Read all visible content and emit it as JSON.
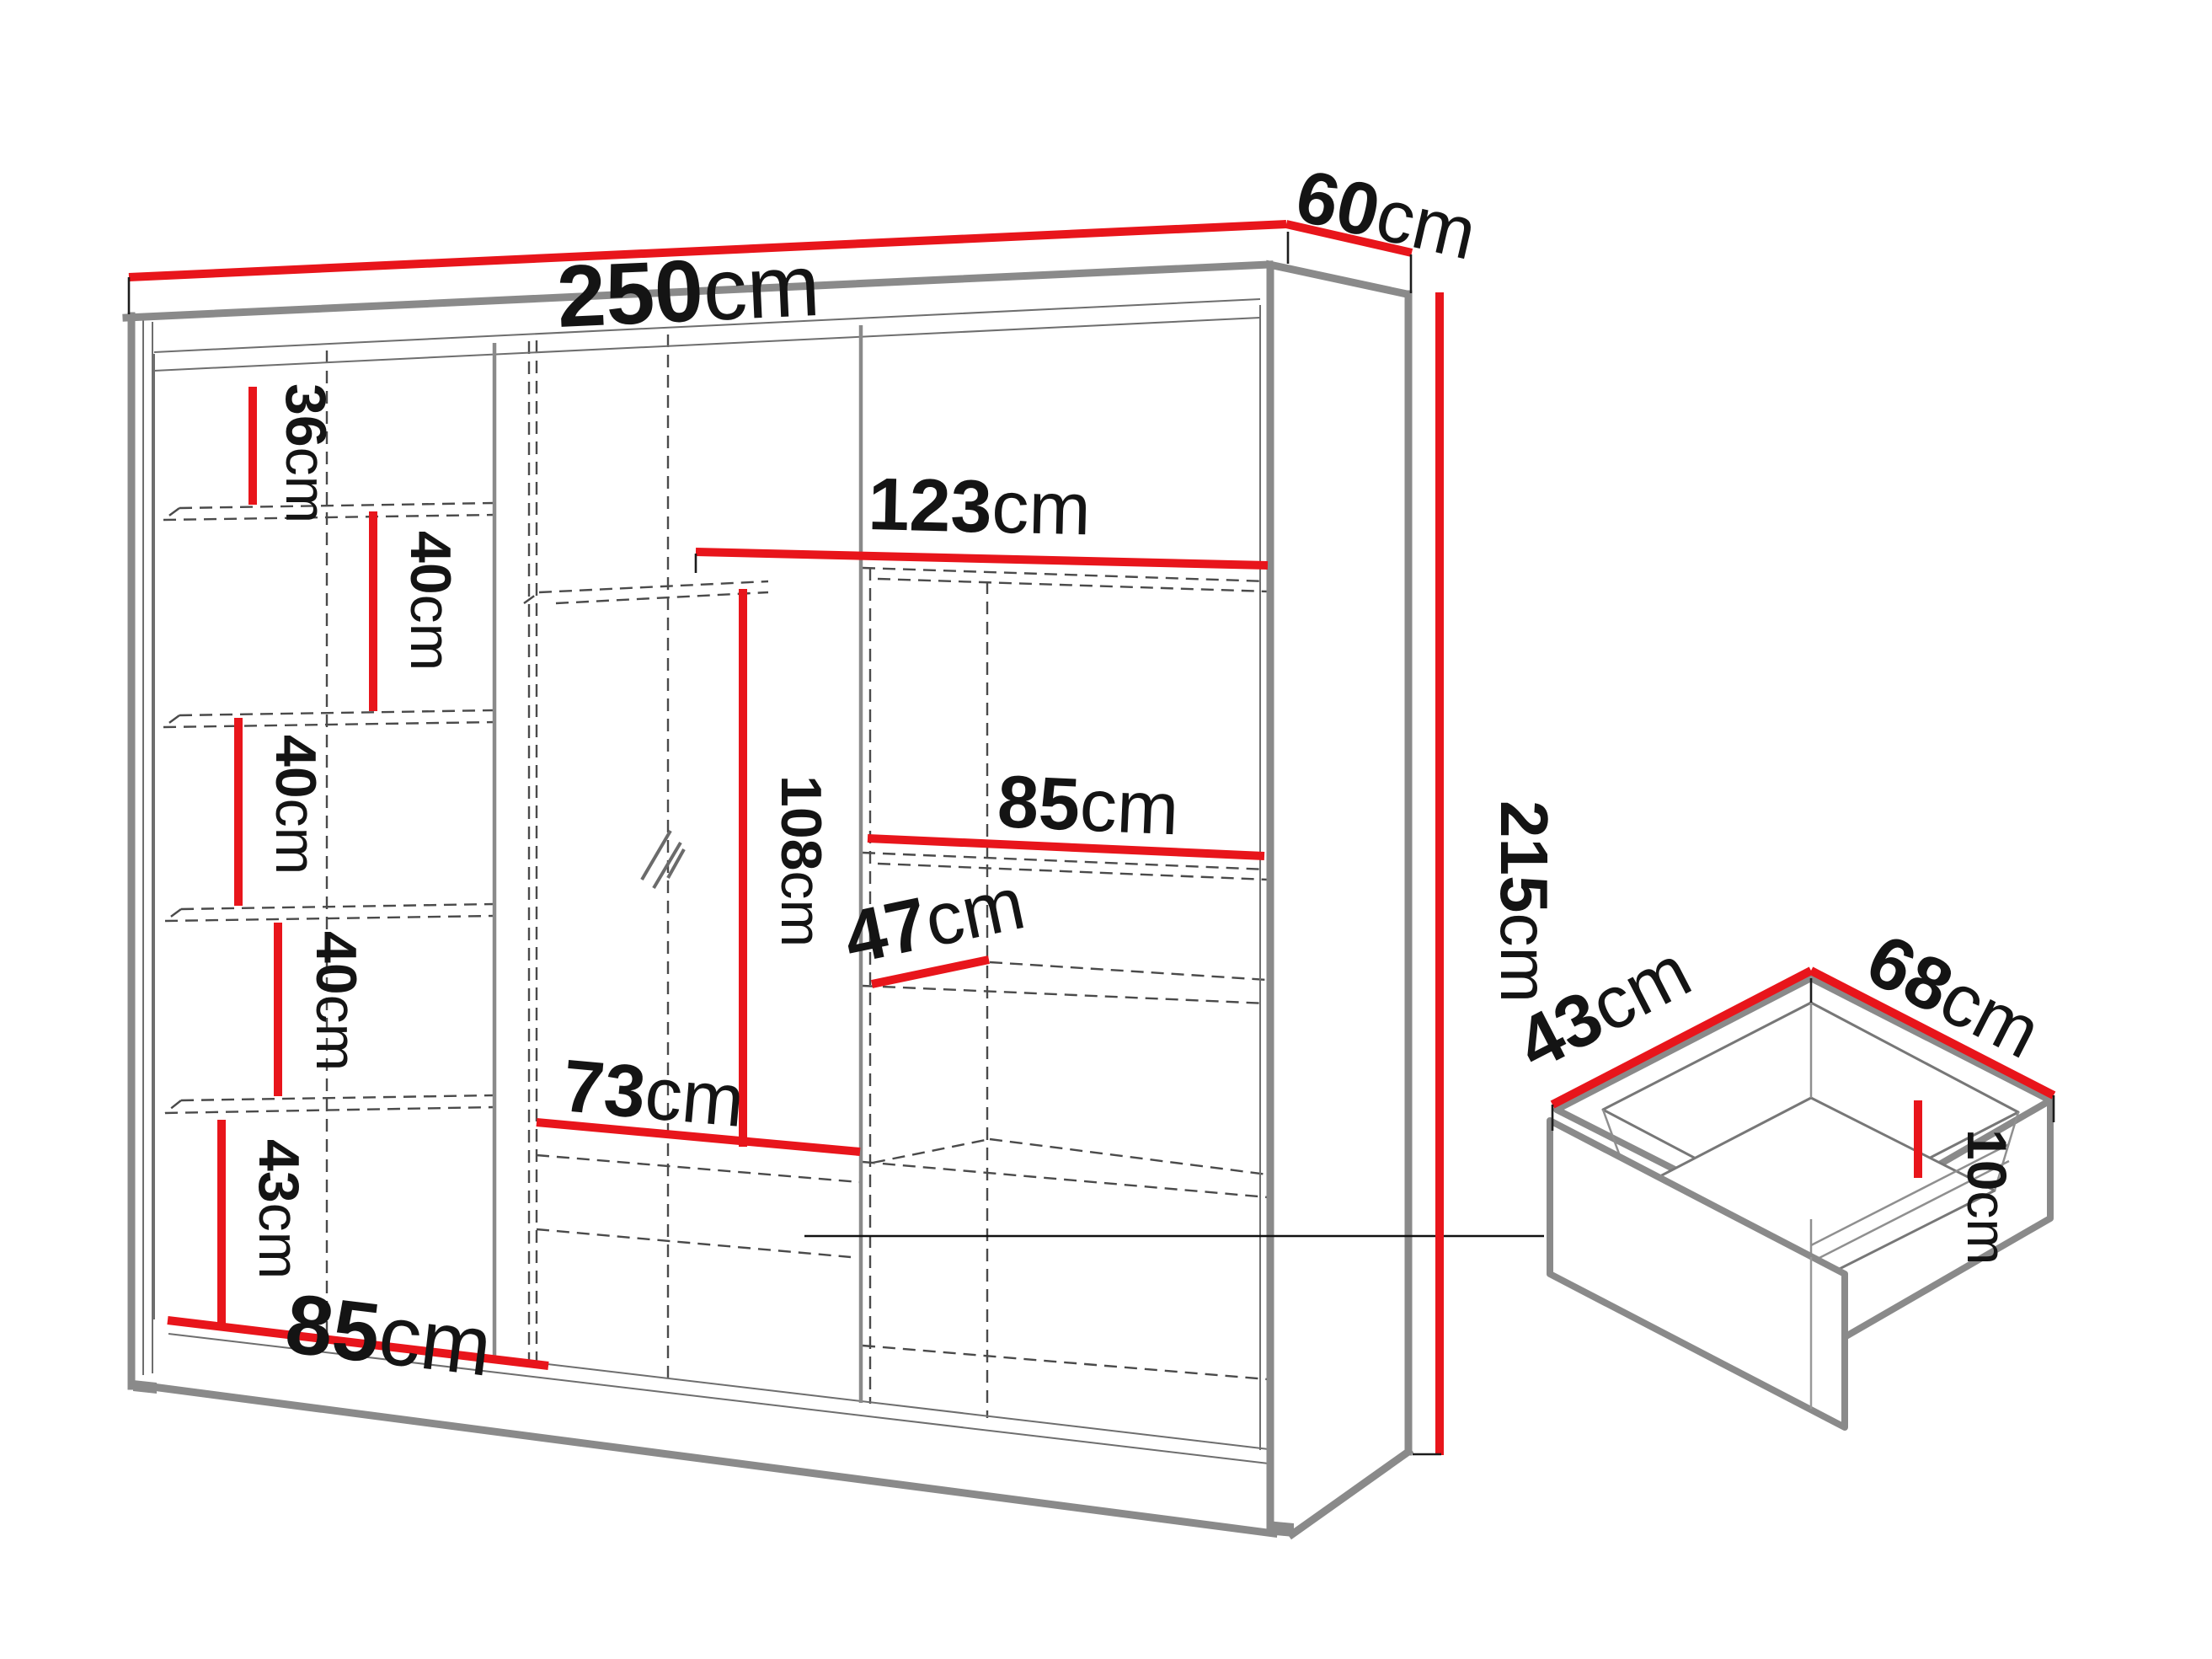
{
  "diagram": {
    "kind": "furniture-dimension-diagram",
    "subject": "three-door sliding wardrobe with mirror and pull-out drawer",
    "unit": "cm",
    "colors": {
      "dimension_line": "#e8151b",
      "outline_gray": "#8a8a8a",
      "hidden_dashed": "#4a4a4a",
      "text": "#141414",
      "background": "#ffffff"
    },
    "wardrobe": {
      "overall_width": "250",
      "overall_depth": "60",
      "overall_height": "215",
      "left_column_section_heights": [
        "36",
        "40",
        "40",
        "40",
        "43"
      ],
      "left_door_width": "85",
      "middle_hanging_height": "108",
      "middle_interior_width": "73",
      "right_door_width": "123",
      "right_shelf_width": "85",
      "right_shelf_depth": "47"
    },
    "drawer": {
      "depth": "43",
      "width": "68",
      "height": "10"
    }
  },
  "labels": {
    "w250": {
      "num": "250",
      "unit": "cm"
    },
    "d60": {
      "num": "60",
      "unit": "cm"
    },
    "h215": {
      "num": "215",
      "unit": "cm"
    },
    "s36": {
      "num": "36",
      "unit": "cm"
    },
    "s40a": {
      "num": "40",
      "unit": "cm"
    },
    "s40b": {
      "num": "40",
      "unit": "cm"
    },
    "s40c": {
      "num": "40",
      "unit": "cm"
    },
    "s43": {
      "num": "43",
      "unit": "cm"
    },
    "b85": {
      "num": "85",
      "unit": "cm"
    },
    "m108": {
      "num": "108",
      "unit": "cm"
    },
    "m73": {
      "num": "73",
      "unit": "cm"
    },
    "r123": {
      "num": "123",
      "unit": "cm"
    },
    "r85": {
      "num": "85",
      "unit": "cm"
    },
    "r47": {
      "num": "47",
      "unit": "cm"
    },
    "dw43": {
      "num": "43",
      "unit": "cm"
    },
    "dw68": {
      "num": "68",
      "unit": "cm"
    },
    "dw10": {
      "num": "10",
      "unit": "cm"
    }
  }
}
